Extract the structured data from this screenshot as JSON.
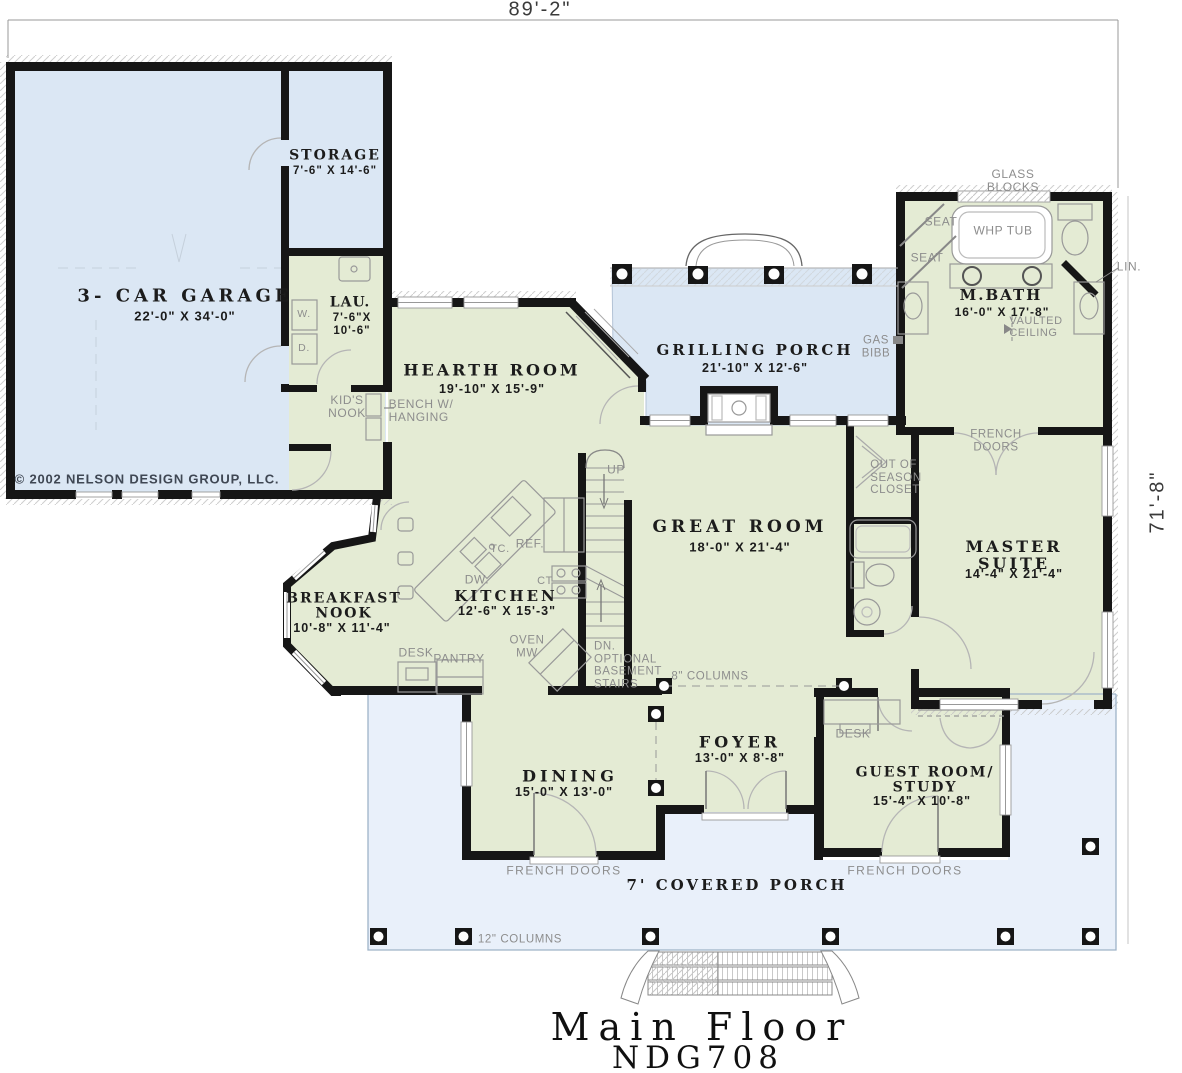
{
  "title": {
    "line1": "Main Floor",
    "line2": "NDG708"
  },
  "dimensions": {
    "top": "89'-2\"",
    "right": "71'-8\""
  },
  "copyright": "© 2002 NELSON DESIGN GROUP, LLC.",
  "rooms": {
    "garage": {
      "name": "3- CAR GARAGE",
      "dims": "22'-0\" X 34'-0\""
    },
    "storage": {
      "name": "STORAGE",
      "dims": "7'-6\" X 14'-6\""
    },
    "laundry": {
      "name": "LAU.",
      "dims1": "7'-6\"X",
      "dims2": "10'-6\""
    },
    "hearth": {
      "name": "HEARTH ROOM",
      "dims": "19'-10\" X 15'-9\""
    },
    "grilling": {
      "name": "GRILLING PORCH",
      "dims": "21'-10\" X 12'-6\""
    },
    "mbath": {
      "name": "M.BATH",
      "dims": "16'-0\" X 17'-8\""
    },
    "great": {
      "name": "GREAT ROOM",
      "dims": "18'-0\" X 21'-4\""
    },
    "master": {
      "name": "MASTER SUITE",
      "dims": "14'-4\" X 21'-4\""
    },
    "kitchen": {
      "name": "KITCHEN",
      "dims": "12'-6\" X 15'-3\""
    },
    "breakfast": {
      "name": "BREAKFAST\nNOOK",
      "dims": "10'-8\" X 11'-4\""
    },
    "dining": {
      "name": "DINING",
      "dims": "15'-0\" X 13'-0\""
    },
    "foyer": {
      "name": "FOYER",
      "dims": "13'-0\" X 8'-8\""
    },
    "guest": {
      "name": "GUEST ROOM/\nSTUDY",
      "dims": "15'-4\" X 10'-8\""
    },
    "porch": {
      "name": "7' COVERED PORCH"
    }
  },
  "annotations": {
    "glass_blocks": "GLASS\nBLOCKS",
    "seat_upper": "SEAT",
    "seat_lower": "SEAT",
    "whp_tub": "WHP TUB",
    "lin": "LIN.",
    "vaulted": "VAULTED\nCEILING",
    "gas_bibb": "GAS\nBIBB",
    "french_doors_master": "FRENCH\nDOORS",
    "out_of_season": "OUT OF\nSEASON\nCLOSET",
    "kids_nook": "KID'S\nNOOK",
    "bench": "BENCH W/\nHANGING",
    "up": "UP",
    "dn": "DN.\nOPTIONAL\nBASEMENT\nSTAIRS",
    "columns8": "8\" COLUMNS",
    "columns12": "12\" COLUMNS",
    "ref": "REF.",
    "tc": "TC.",
    "dw": "DW.",
    "ct": "CT",
    "oven_mw": "OVEN\nMW",
    "desk_kitchen": "DESK",
    "pantry": "PANTRY",
    "desk_hall": "DESK",
    "washer": "W.",
    "dryer": "D.",
    "french_doors_dining": "FRENCH DOORS",
    "french_doors_guest": "FRENCH DOORS"
  },
  "colors": {
    "garage_blue": "#dbe7f4",
    "porch_blue": "#e9f0fa",
    "room_green": "#e4ebd4",
    "wall": "#161616",
    "annotation_gray": "#8d8d8d"
  }
}
